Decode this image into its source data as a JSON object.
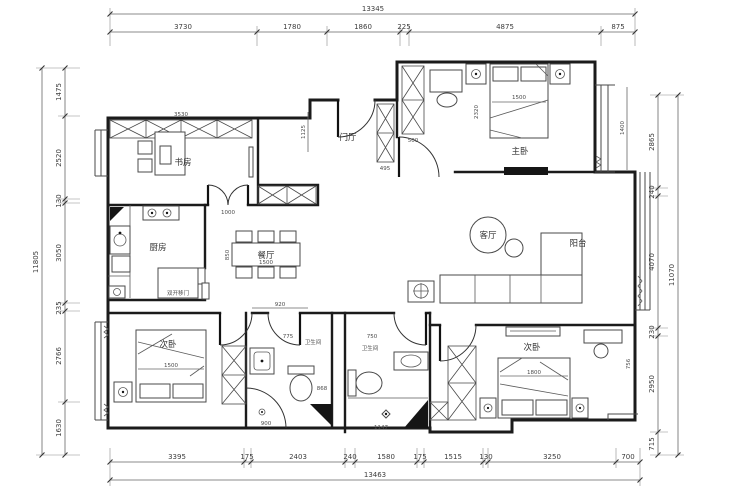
{
  "totals": {
    "top": "13345",
    "bottom": "13463",
    "left": "11805",
    "right": "11070"
  },
  "dims": {
    "top": [
      "3730",
      "1780",
      "1860",
      "225",
      "4875",
      "875"
    ],
    "bottom": [
      "3395",
      "175",
      "2403",
      "240",
      "1580",
      "175",
      "1515",
      "130",
      "3250",
      "700"
    ],
    "left": [
      "1475",
      "2520",
      "130",
      "3050",
      "235",
      "2766",
      "1630"
    ],
    "right": [
      "2865",
      "240",
      "4070",
      "230",
      "2950",
      "715"
    ]
  },
  "rooms": {
    "study": "书房",
    "hall": "门厅",
    "master": "主卧",
    "kitchen": "厨房",
    "dining": "餐厅",
    "living": "客厅",
    "balcony": "阳台",
    "bedroom_bl": "次卧",
    "bath1": "卫生间",
    "bath2": "卫生间",
    "bedroom_br": "次卧"
  },
  "annotations": {
    "sliding_door": "双开移门"
  },
  "inner": {
    "study_w": "3530",
    "hall_h": "1125",
    "study_door": "1000",
    "closet_hall": "495",
    "wardrobe_master": "500",
    "bed_master_w": "1500",
    "bed_master_h": "2320",
    "bay_master": "1400",
    "corridor": "920",
    "bath1_w": "775",
    "bath2_door": "750",
    "shower1_w": "900",
    "bath1_d": "868",
    "shower2_w": "1147",
    "bed_bl": "1500",
    "bed_br": "1800",
    "br_side": "756",
    "dining_w": "1500",
    "dining_h": "850"
  },
  "colors": {
    "wall": "#1b1b1b",
    "line": "#4a4a4a",
    "dim": "#3c3c3c",
    "bg": "#ffffff"
  }
}
